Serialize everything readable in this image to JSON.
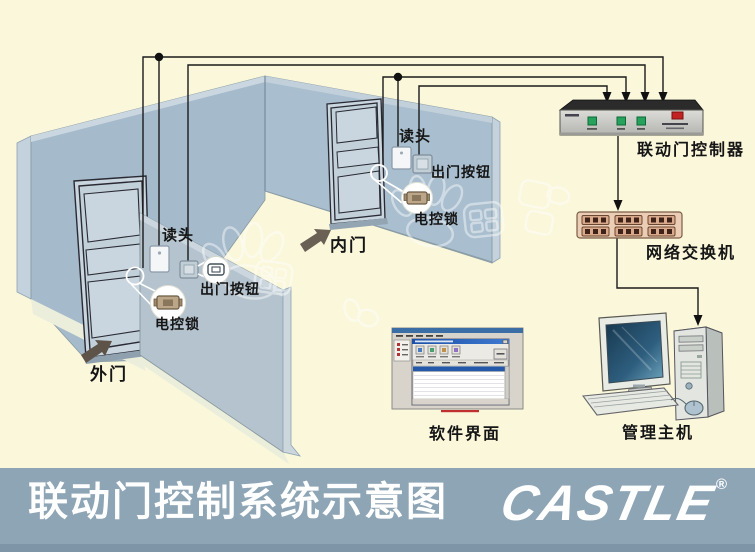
{
  "title_bar": {
    "title": "联动门控制系统示意图",
    "brand": "CASTLE",
    "registered_mark": "®",
    "bar_color": "#8EA5B6",
    "text_color": "#FFFFFF"
  },
  "diagram": {
    "outer_door": {
      "door_label": "外门",
      "reader_label": "读头",
      "exit_button_label": "出门按钮",
      "lock_label": "电控锁"
    },
    "inner_door": {
      "door_label": "内门",
      "reader_label": "读头",
      "exit_button_label": "出门按钮",
      "lock_label": "电控锁"
    },
    "equipment": {
      "controller_label": "联动门控制器",
      "switch_label": "网络交换机",
      "software_label": "软件界面",
      "host_label": "管理主机"
    },
    "colors": {
      "background": "#FAF7DB",
      "left_wall": "#A5BACB",
      "back_wall": "#A9BECE",
      "partition_wall": "#B5C3CE",
      "wire": "#1B1B1B",
      "controller_button_green": "#27A25C",
      "controller_switch_red": "#C32222",
      "switch_body_tan": "#EACDB4",
      "screen_blue": "#17384F"
    }
  }
}
